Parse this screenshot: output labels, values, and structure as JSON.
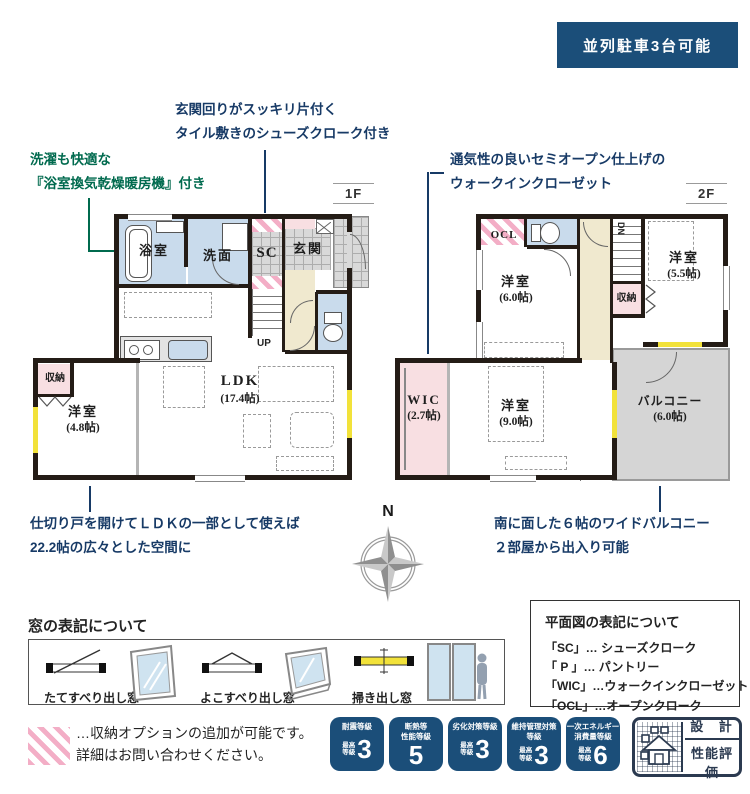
{
  "banner": {
    "text": "並列駐車3台可能"
  },
  "floor_labels": {
    "f1": "1F",
    "f2": "2F"
  },
  "annotations": {
    "shoes": {
      "l1": "玄関回りがスッキリ片付く",
      "l2": "タイル敷きのシューズクローク付き"
    },
    "bath": {
      "l1": "洗濯も快適な",
      "l2": "『浴室換気乾燥暖房機』付き"
    },
    "wic": {
      "l1": "通気性の良いセミオープン仕上げの",
      "l2": "ウォークインクローゼット"
    },
    "ldk": {
      "l1": "仕切り戸を開けてＬＤＫの一部として使えば",
      "l2": "22.2帖の広々とした空間に"
    },
    "balcony": {
      "l1": "南に面した６帖のワイドバルコニー",
      "l2": "２部屋から出入り可能"
    }
  },
  "floor1": {
    "bath": "浴室",
    "wash": "洗面",
    "sc": "SC",
    "entrance": "玄関",
    "up": "UP",
    "storage": "収納",
    "west": "洋室",
    "west_size": "(4.8帖)",
    "ldk": "LDK",
    "ldk_size": "(17.4帖)"
  },
  "floor2": {
    "ocl": "OCL",
    "dn": "DN",
    "west6": "洋室",
    "west6_size": "(6.0帖)",
    "west55": "洋室",
    "west55_size": "(5.5帖)",
    "storage": "収納",
    "wic": "WIC",
    "wic_size": "(2.7帖)",
    "west9": "洋室",
    "west9_size": "(9.0帖)",
    "balcony": "バルコニー",
    "balcony_size": "(6.0帖)"
  },
  "compass": {
    "n": "N"
  },
  "window_legend": {
    "title": "窓の表記について",
    "items": [
      {
        "label": "たてすべり出し窓"
      },
      {
        "label": "よこすべり出し窓"
      },
      {
        "label": "掃き出し窓"
      }
    ]
  },
  "plan_legend": {
    "title": "平面図の表記について",
    "items": [
      "「SC」… シューズクローク",
      "「 P 」… パントリー",
      "「WIC」…ウォークインクローゼット",
      "「OCL」…オープンクローク"
    ]
  },
  "storage_note": {
    "l1": "…収納オプションの追加が可能です。",
    "l2": "詳細はお問い合わせください。"
  },
  "badges": [
    {
      "t1": "耐震等級",
      "t2": "",
      "p1": "最高",
      "p2": "等級",
      "num": "3"
    },
    {
      "t1": "断熱等",
      "t2": "性能等級",
      "p1": "",
      "p2": "",
      "num": "5"
    },
    {
      "t1": "劣化対策等級",
      "t2": "",
      "p1": "最高",
      "p2": "等級",
      "num": "3"
    },
    {
      "t1": "維持管理対策",
      "t2": "等級",
      "p1": "最高",
      "p2": "等級",
      "num": "3"
    },
    {
      "t1": "一次エネルギー",
      "t2": "消費量等級",
      "p1": "最高",
      "p2": "等級",
      "num": "6"
    }
  ],
  "seal": {
    "top": "設 計",
    "bottom": "性能評価"
  },
  "colors": {
    "accent_blue": "#1b4e79",
    "navy_text": "#173a66",
    "green_text": "#006a4e",
    "room_blue": "#c9dbec",
    "hall_cream": "#f0e9cf",
    "pink": "#f8dfe2",
    "hatch_pink": "#f3aec6",
    "tile_gray": "#d9d9d9",
    "balcony_gray": "#d5d5d5",
    "wall": "#241c16",
    "window_yellow": "#f2e23a"
  }
}
